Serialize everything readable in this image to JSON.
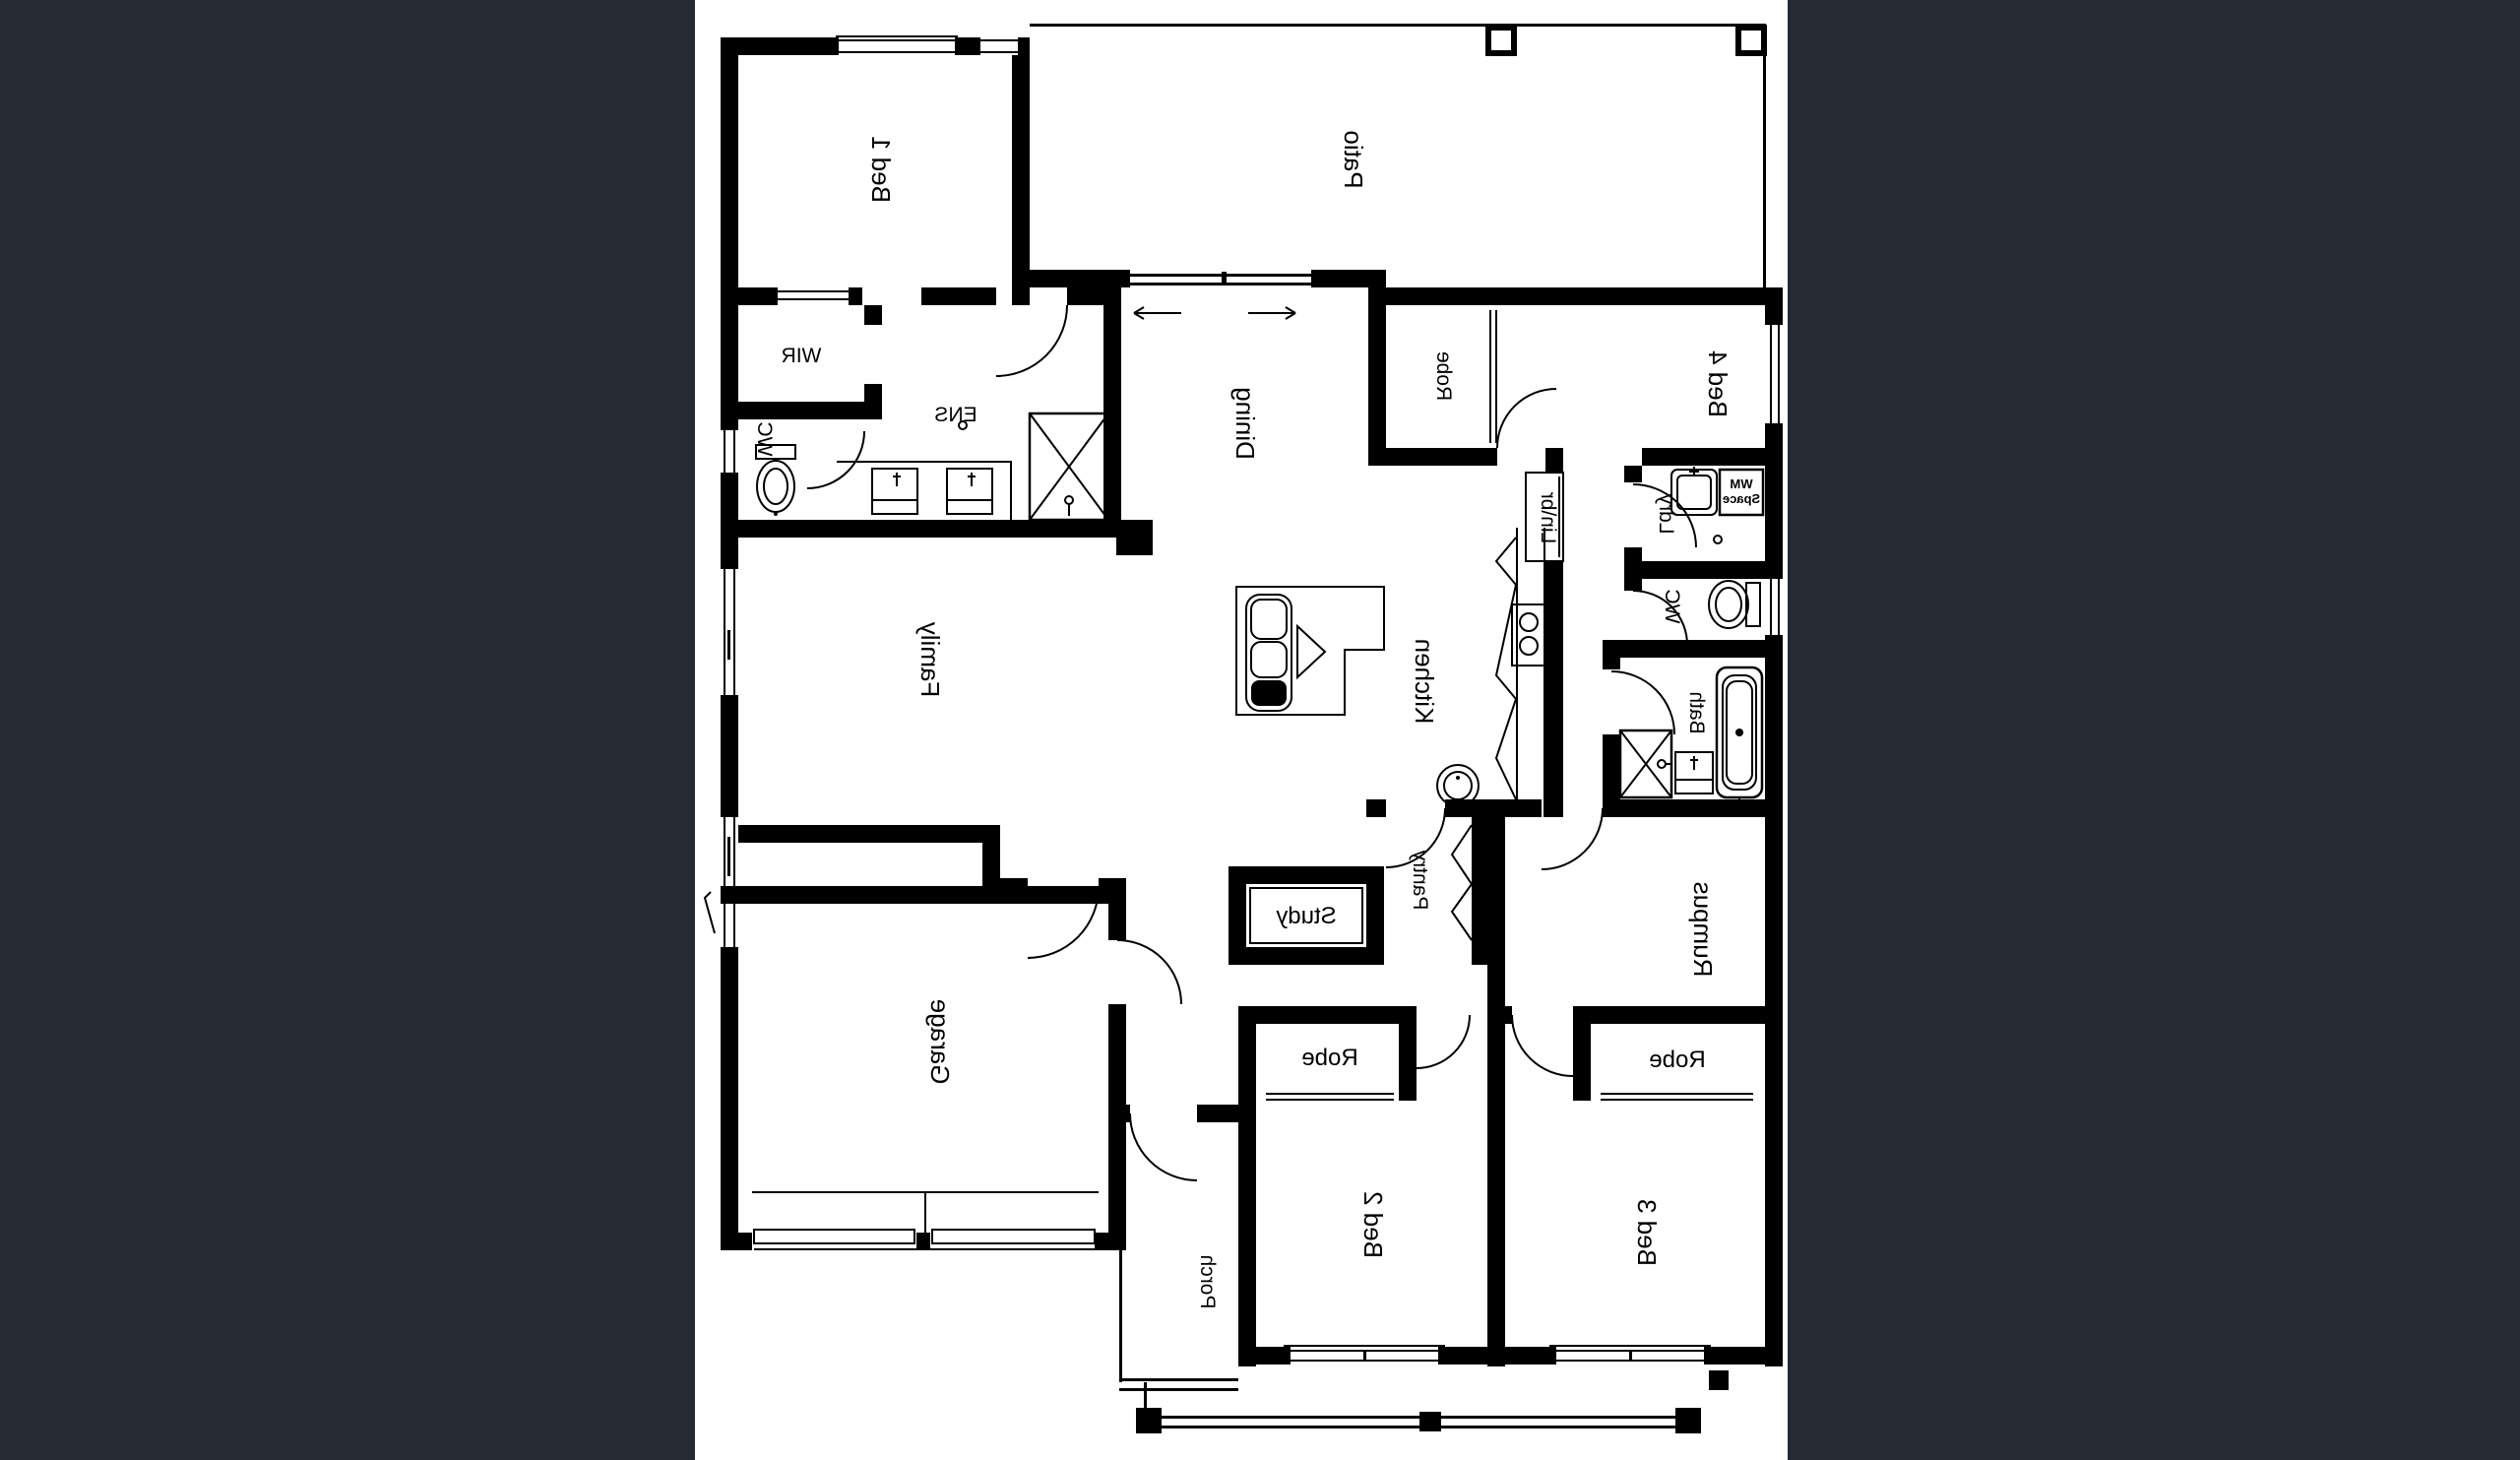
{
  "page": {
    "background_color": "#262b33",
    "paper_color": "#ffffff",
    "ink_color": "#000000",
    "window_accent_color": "#3a57c4",
    "content_type": "floor-plan",
    "plan_is_mirrored": true
  },
  "rooms": {
    "bed1": {
      "label": "Bed 1"
    },
    "patio": {
      "label": "Patio"
    },
    "wir": {
      "label": "WIR"
    },
    "ens": {
      "label": "ENS"
    },
    "wc_ens": {
      "label": "WC"
    },
    "robe_bed4": {
      "label": "Robe"
    },
    "bed4": {
      "label": "Bed 4"
    },
    "dining": {
      "label": "Dining"
    },
    "family": {
      "label": "Family"
    },
    "kitchen": {
      "label": "Kitchen"
    },
    "linen": {
      "label": "Lin\\br"
    },
    "laundry": {
      "label": "Ldry"
    },
    "wm_space": {
      "line1": "WM",
      "line2": "Space"
    },
    "wc_main": {
      "label": "WC"
    },
    "bath": {
      "label": "Bath"
    },
    "pantry": {
      "label": "Pantry"
    },
    "study": {
      "label": "Study"
    },
    "rumpus": {
      "label": "Rumpus"
    },
    "garage": {
      "label": "Garage"
    },
    "robe_bed2": {
      "label": "Robe"
    },
    "robe_bed3": {
      "label": "Robe"
    },
    "bed2": {
      "label": "Bed 2"
    },
    "bed3": {
      "label": "Bed 3"
    },
    "porch": {
      "label": "Porch"
    }
  }
}
